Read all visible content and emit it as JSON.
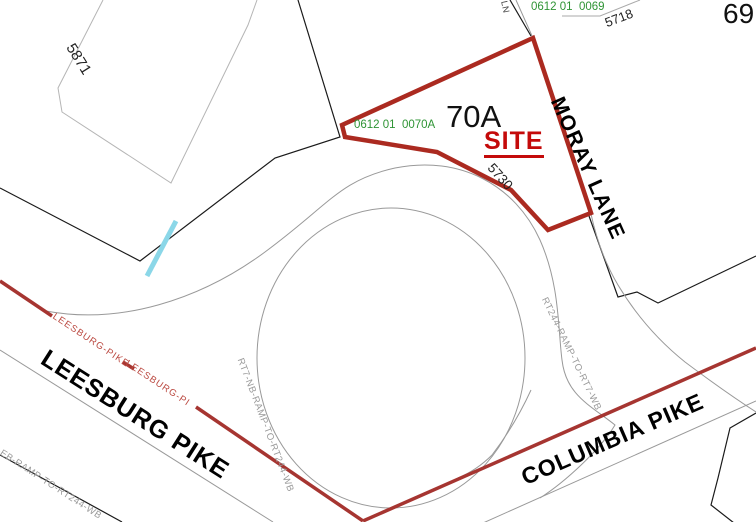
{
  "canvas": {
    "width": 756,
    "height": 522
  },
  "colors": {
    "road_red": "#A63531",
    "parcel_red": "#AB2A20",
    "site_red": "#C40A0A",
    "parcel_id_green": "#2F9435",
    "road_edge_gray": "#999999",
    "water_cyan": "#8BD7E8"
  },
  "site_parcel": {
    "block_label": "70A",
    "site_label": "SITE",
    "parcel_id": "0612 01  0070A",
    "house_number": "5730"
  },
  "neighbor_parcels": {
    "parcel_69": {
      "block_label": "69",
      "parcel_id": "0612 01  0069",
      "house_number": "5718"
    },
    "parcel_5871": {
      "house_number": "5871"
    }
  },
  "streets": {
    "moray_lane": "MORAY LANE",
    "leesburg_pike": "LEESBURG PIKE",
    "columbia_pike": "COLUMBIA PIKE",
    "leesburg_centerline_label_1": "LEESBURG-PIKE",
    "leesburg_centerline_label_2": "LEESBURG-PI",
    "ramp_rt7_nb": "RT7-NB-RAMP-TO-RT244-WB",
    "ramp_rt244": "RT244-RAMP-TO-RT7-WB",
    "ramp_rt7_eb": "RT7-EB-RAMP-TO-RT244-WB",
    "cutoff_street_suffix": "LN"
  }
}
